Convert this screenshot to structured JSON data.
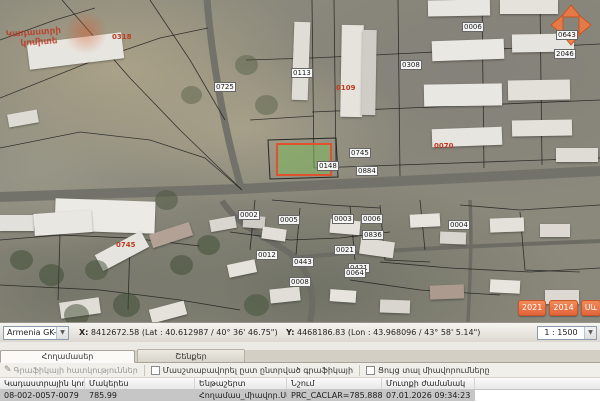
{
  "map": {
    "watermark": {
      "line1": "Կադաստրի",
      "line2": "կոմիտե"
    },
    "year_buttons": [
      "2021",
      "2014",
      "Սև",
      "3"
    ],
    "parcel_labels": [
      {
        "code": "0318",
        "x": 112,
        "y": 33,
        "style": "red"
      },
      {
        "code": "0725",
        "x": 214,
        "y": 82,
        "style": "box"
      },
      {
        "code": "0113",
        "x": 291,
        "y": 68,
        "style": "box"
      },
      {
        "code": "0109",
        "x": 336,
        "y": 84,
        "style": "red"
      },
      {
        "code": "0308",
        "x": 400,
        "y": 60,
        "style": "box"
      },
      {
        "code": "0006",
        "x": 462,
        "y": 22,
        "style": "box"
      },
      {
        "code": "0643",
        "x": 556,
        "y": 30,
        "style": "box"
      },
      {
        "code": "2046",
        "x": 554,
        "y": 49,
        "style": "box"
      },
      {
        "code": "0070",
        "x": 434,
        "y": 142,
        "style": "red"
      },
      {
        "code": "0745",
        "x": 349,
        "y": 148,
        "style": "box"
      },
      {
        "code": "0884",
        "x": 356,
        "y": 166,
        "style": "box"
      },
      {
        "code": "0148",
        "x": 317,
        "y": 161,
        "style": "box"
      },
      {
        "code": "0002",
        "x": 238,
        "y": 210,
        "style": "box"
      },
      {
        "code": "0005",
        "x": 278,
        "y": 215,
        "style": "box"
      },
      {
        "code": "0003",
        "x": 332,
        "y": 214,
        "style": "box"
      },
      {
        "code": "0006",
        "x": 361,
        "y": 214,
        "style": "box"
      },
      {
        "code": "0836",
        "x": 362,
        "y": 230,
        "style": "box"
      },
      {
        "code": "0021",
        "x": 334,
        "y": 245,
        "style": "box"
      },
      {
        "code": "0443",
        "x": 292,
        "y": 257,
        "style": "box"
      },
      {
        "code": "0421",
        "x": 348,
        "y": 263,
        "style": "box"
      },
      {
        "code": "0012",
        "x": 256,
        "y": 250,
        "style": "box"
      },
      {
        "code": "0004",
        "x": 448,
        "y": 220,
        "style": "box"
      },
      {
        "code": "0008",
        "x": 289,
        "y": 277,
        "style": "box"
      },
      {
        "code": "0064",
        "x": 344,
        "y": 268,
        "style": "box"
      },
      {
        "code": "0745",
        "x": 116,
        "y": 241,
        "style": "red"
      }
    ]
  },
  "statusbar": {
    "projection": "Armenia GK-8",
    "x_label": "X:",
    "x_text": "8412672.58 (Lat : 40.612987 / 40° 36' 46.75\")",
    "y_label": "Y:",
    "y_text": "4468186.83 (Lon : 43.968096 / 43° 58' 5.14\")",
    "scale": "1 : 1500"
  },
  "panel": {
    "tabs": {
      "parcels": "Հողամասեր",
      "buildings": "Շենքեր"
    },
    "toolbar": {
      "properties": "Գրաֆիկայի հատկություններ",
      "zoom_to_selected": "Մասշտաբավորել ըստ ընտրված գրաֆիկայի",
      "show_units": "Ցույց տալ միավորումները"
    },
    "table": {
      "headers": [
        "Կադաստրային կոդ",
        "Մակերես",
        "Ենթաշերտ",
        "Նշում",
        "Մուտքի ժամանակ"
      ],
      "row": [
        "08-002-0057-0079",
        "785.99",
        "Հողամաս_միավոր.Սահմանվ",
        "PRC_CACLAR=785.8884738 , PRC...",
        "07.01.2026 09:34:23"
      ]
    }
  }
}
